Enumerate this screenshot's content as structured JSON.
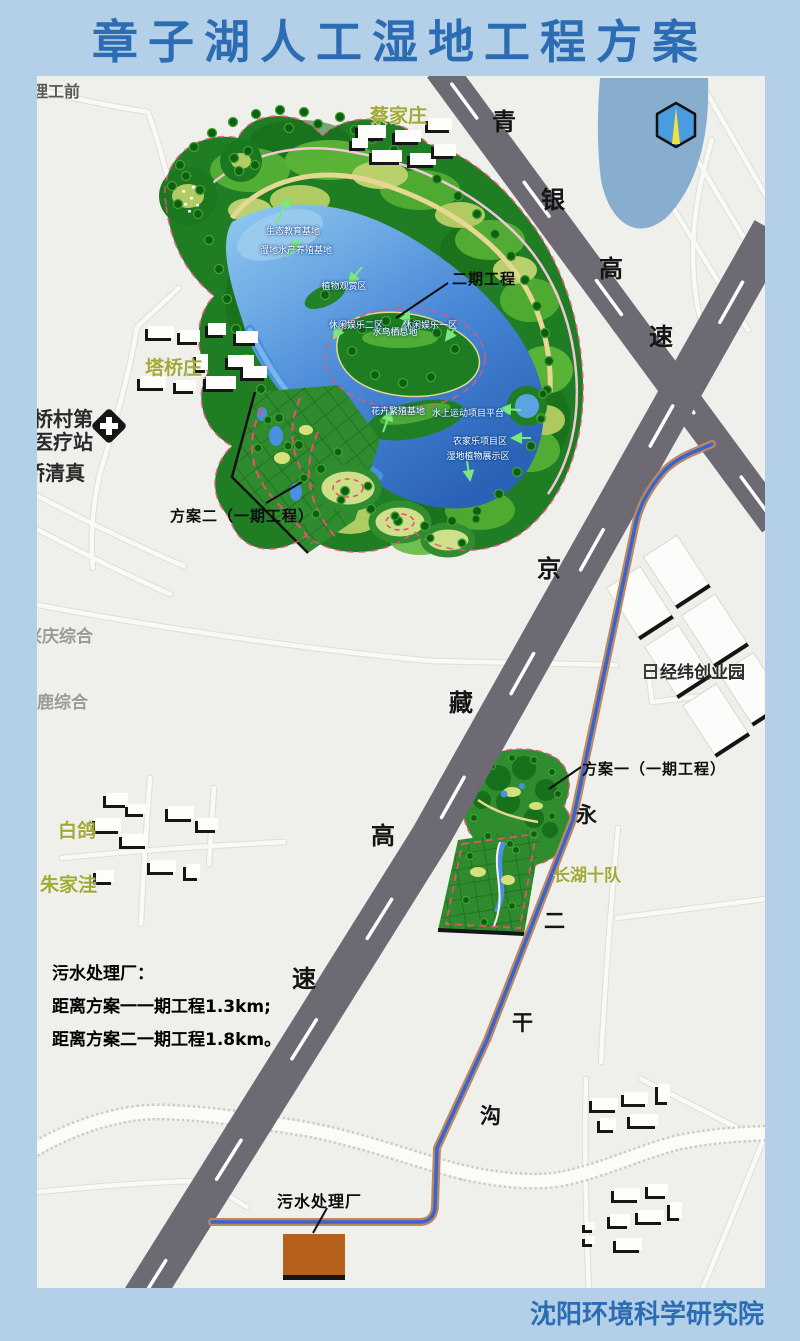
{
  "page": {
    "title": "章子湖人工湿地工程方案",
    "footer": "沈阳环境科学研究院"
  },
  "colors": {
    "page_bg": "#b4d0e9",
    "title_blue": "#2b6cb3",
    "map_bg": "#efefec",
    "highway_gray": "#6e6a73",
    "water_blue": "#88aecf",
    "lake_blue": "#3c86d8",
    "wetland_green": "#2e8a2c",
    "channel_blue": "#3566d0",
    "channel_tan": "#c0875e",
    "plant_brown": "#b5611c",
    "village_olive": "#a2aa36"
  },
  "expressways": {
    "qingyin": [
      "青",
      "银",
      "高",
      "速"
    ],
    "jingzang": [
      "京",
      "藏",
      "高",
      "速"
    ]
  },
  "canal": [
    "永",
    "二",
    "干",
    "沟"
  ],
  "places": {
    "caijiazhuang": "蔡家庄",
    "taqiaozhuang": "塔桥庄",
    "baige": "白鸽",
    "zhujiawa": "朱家洼",
    "changhushidui": "长湖十队",
    "jingwei_park": "经纬创业园",
    "xingqing": "兴庆综合",
    "selu": "色鹿综合",
    "clinic_line1": "桥村第",
    "clinic_line2": "医疗站",
    "qiaoqingzhen": "桥清真",
    "top_left_partial": "理工前"
  },
  "zones": [
    "生态教育基地",
    "湿地水产养殖基地",
    "植物观赏区",
    "休闲娱乐二区",
    "水鸟栖息地",
    "休闲娱乐一区",
    "花卉繁殖基地",
    "水上运动项目平台",
    "农家乐项目区",
    "湿地植物展示区"
  ],
  "callouts": {
    "phase2": "二期工程",
    "plan2": "方案二（一期工程）",
    "plan1": "方案一（一期工程）",
    "sewage_plant": "污水处理厂"
  },
  "info_block": [
    "污水处理厂：",
    "距离方案一一期工程1.3km;",
    "距离方案二一期工程1.8km。"
  ]
}
